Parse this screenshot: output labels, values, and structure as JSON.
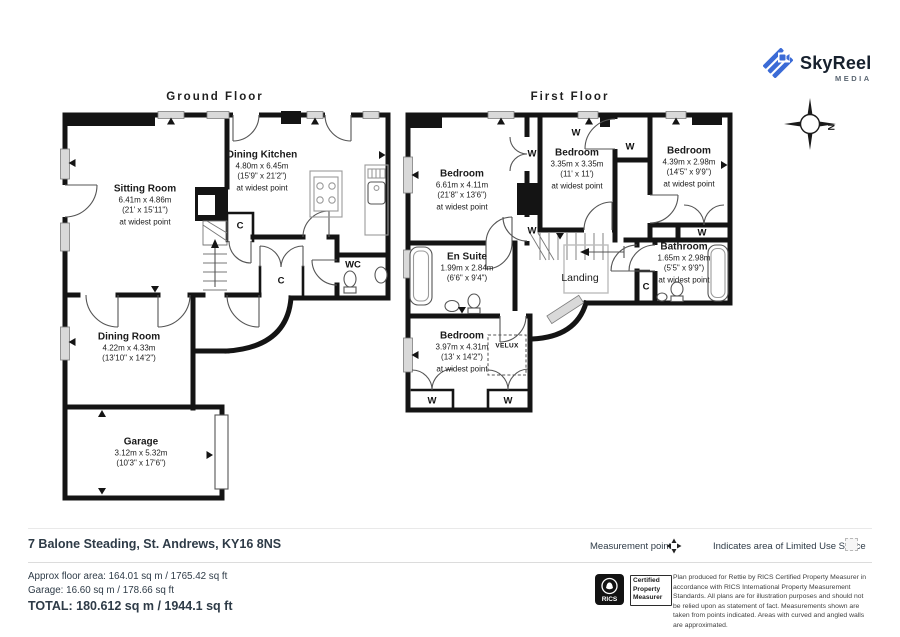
{
  "brand": {
    "name": "SkyReel",
    "tagline": "MEDIA"
  },
  "compass_label": "N",
  "floors": {
    "ground": {
      "title": "Ground Floor",
      "rooms": {
        "sitting_room": {
          "name": "Sitting Room",
          "metric": "6.41m x 4.86m",
          "imperial": "(21' x 15'11\")",
          "note": "at widest point"
        },
        "dining_kitchen": {
          "name": "Dining Kitchen",
          "metric": "4.80m x 6.45m",
          "imperial": "(15'9\" x 21'2\")",
          "note": "at widest point"
        },
        "dining_room": {
          "name": "Dining Room",
          "metric": "4.22m x 4.33m",
          "imperial": "(13'10\" x 14'2\")"
        },
        "garage": {
          "name": "Garage",
          "metric": "3.12m x 5.32m",
          "imperial": "(10'3\" x 17'6\")"
        },
        "wc": {
          "name": "WC"
        }
      }
    },
    "first": {
      "title": "First Floor",
      "rooms": {
        "bedroom_1": {
          "name": "Bedroom",
          "metric": "6.61m x 4.11m",
          "imperial": "(21'8\" x 13'6\")",
          "note": "at widest point"
        },
        "bedroom_2": {
          "name": "Bedroom",
          "metric": "3.35m x 3.35m",
          "imperial": "(11' x 11')",
          "note": "at widest point"
        },
        "bedroom_3": {
          "name": "Bedroom",
          "metric": "4.39m x 2.98m",
          "imperial": "(14'5\" x 9'9\")",
          "note": "at widest point"
        },
        "bedroom_4": {
          "name": "Bedroom",
          "metric": "3.97m x 4.31m",
          "imperial": "(13' x 14'2\")",
          "note": "at widest point"
        },
        "en_suite": {
          "name": "En Suite",
          "metric": "1.99m x 2.84m",
          "imperial": "(6'6\" x 9'4\")"
        },
        "bathroom": {
          "name": "Bathroom",
          "metric": "1.65m x 2.98m",
          "imperial": "(5'5\" x 9'9\")",
          "note": "at widest point"
        },
        "landing": {
          "name": "Landing"
        }
      }
    }
  },
  "markers": {
    "cupboard": "C",
    "wardrobe": "W",
    "velux": "VELUX"
  },
  "property": {
    "address": "7 Balone Steading, St. Andrews, KY16 8NS"
  },
  "areas": {
    "approx": "Approx floor area: 164.01 sq m / 1765.42 sq ft",
    "garage": "Garage: 16.60 sq m / 178.66 sq ft",
    "total": "TOTAL: 180.612 sq m / 1944.1 sq ft"
  },
  "legend": {
    "measurement_point": "Measurement point",
    "limited_use": "Indicates area of  Limited Use Space"
  },
  "certification": {
    "org": "RICS",
    "label": "Certified Property Measurer",
    "disclaimer": "Plan produced for Rettie by RICS Certified Property Measurer in accordance with RICS International Property Measurement Standards.  All plans are for illustration purposes and should not be relied upon as statement of fact. Measurements shown are taken from points indicated. Areas with curved and angled walls are approximated."
  }
}
